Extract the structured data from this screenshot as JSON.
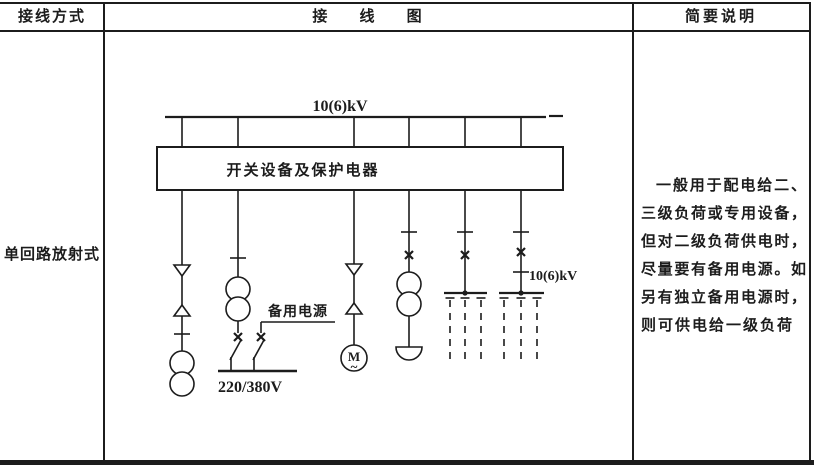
{
  "table": {
    "headers": {
      "col1": "接线方式",
      "col2": "接 线 图",
      "col3": "简要说明"
    },
    "row": {
      "method": "单回路放射式",
      "description_lines": [
        "一般用于配电给二、",
        "三级负荷或专用设备，",
        "但对二级负荷供电时，",
        "尽量要有备用电源。如",
        "另有独立备用电源时，",
        "则可供电给一级负荷"
      ]
    }
  },
  "diagram": {
    "bus_voltage_label": "10(6)kV",
    "switchgear_box_label": "开关设备及保护电器",
    "backup_power_label": "备用电源",
    "lv_bus_label": "220/380V",
    "branch_voltage_label": "10(6)kV",
    "motor_letter": "M",
    "motor_wave": "~"
  },
  "colors": {
    "ink": "#1c1c1c",
    "background": "#ffffff"
  }
}
